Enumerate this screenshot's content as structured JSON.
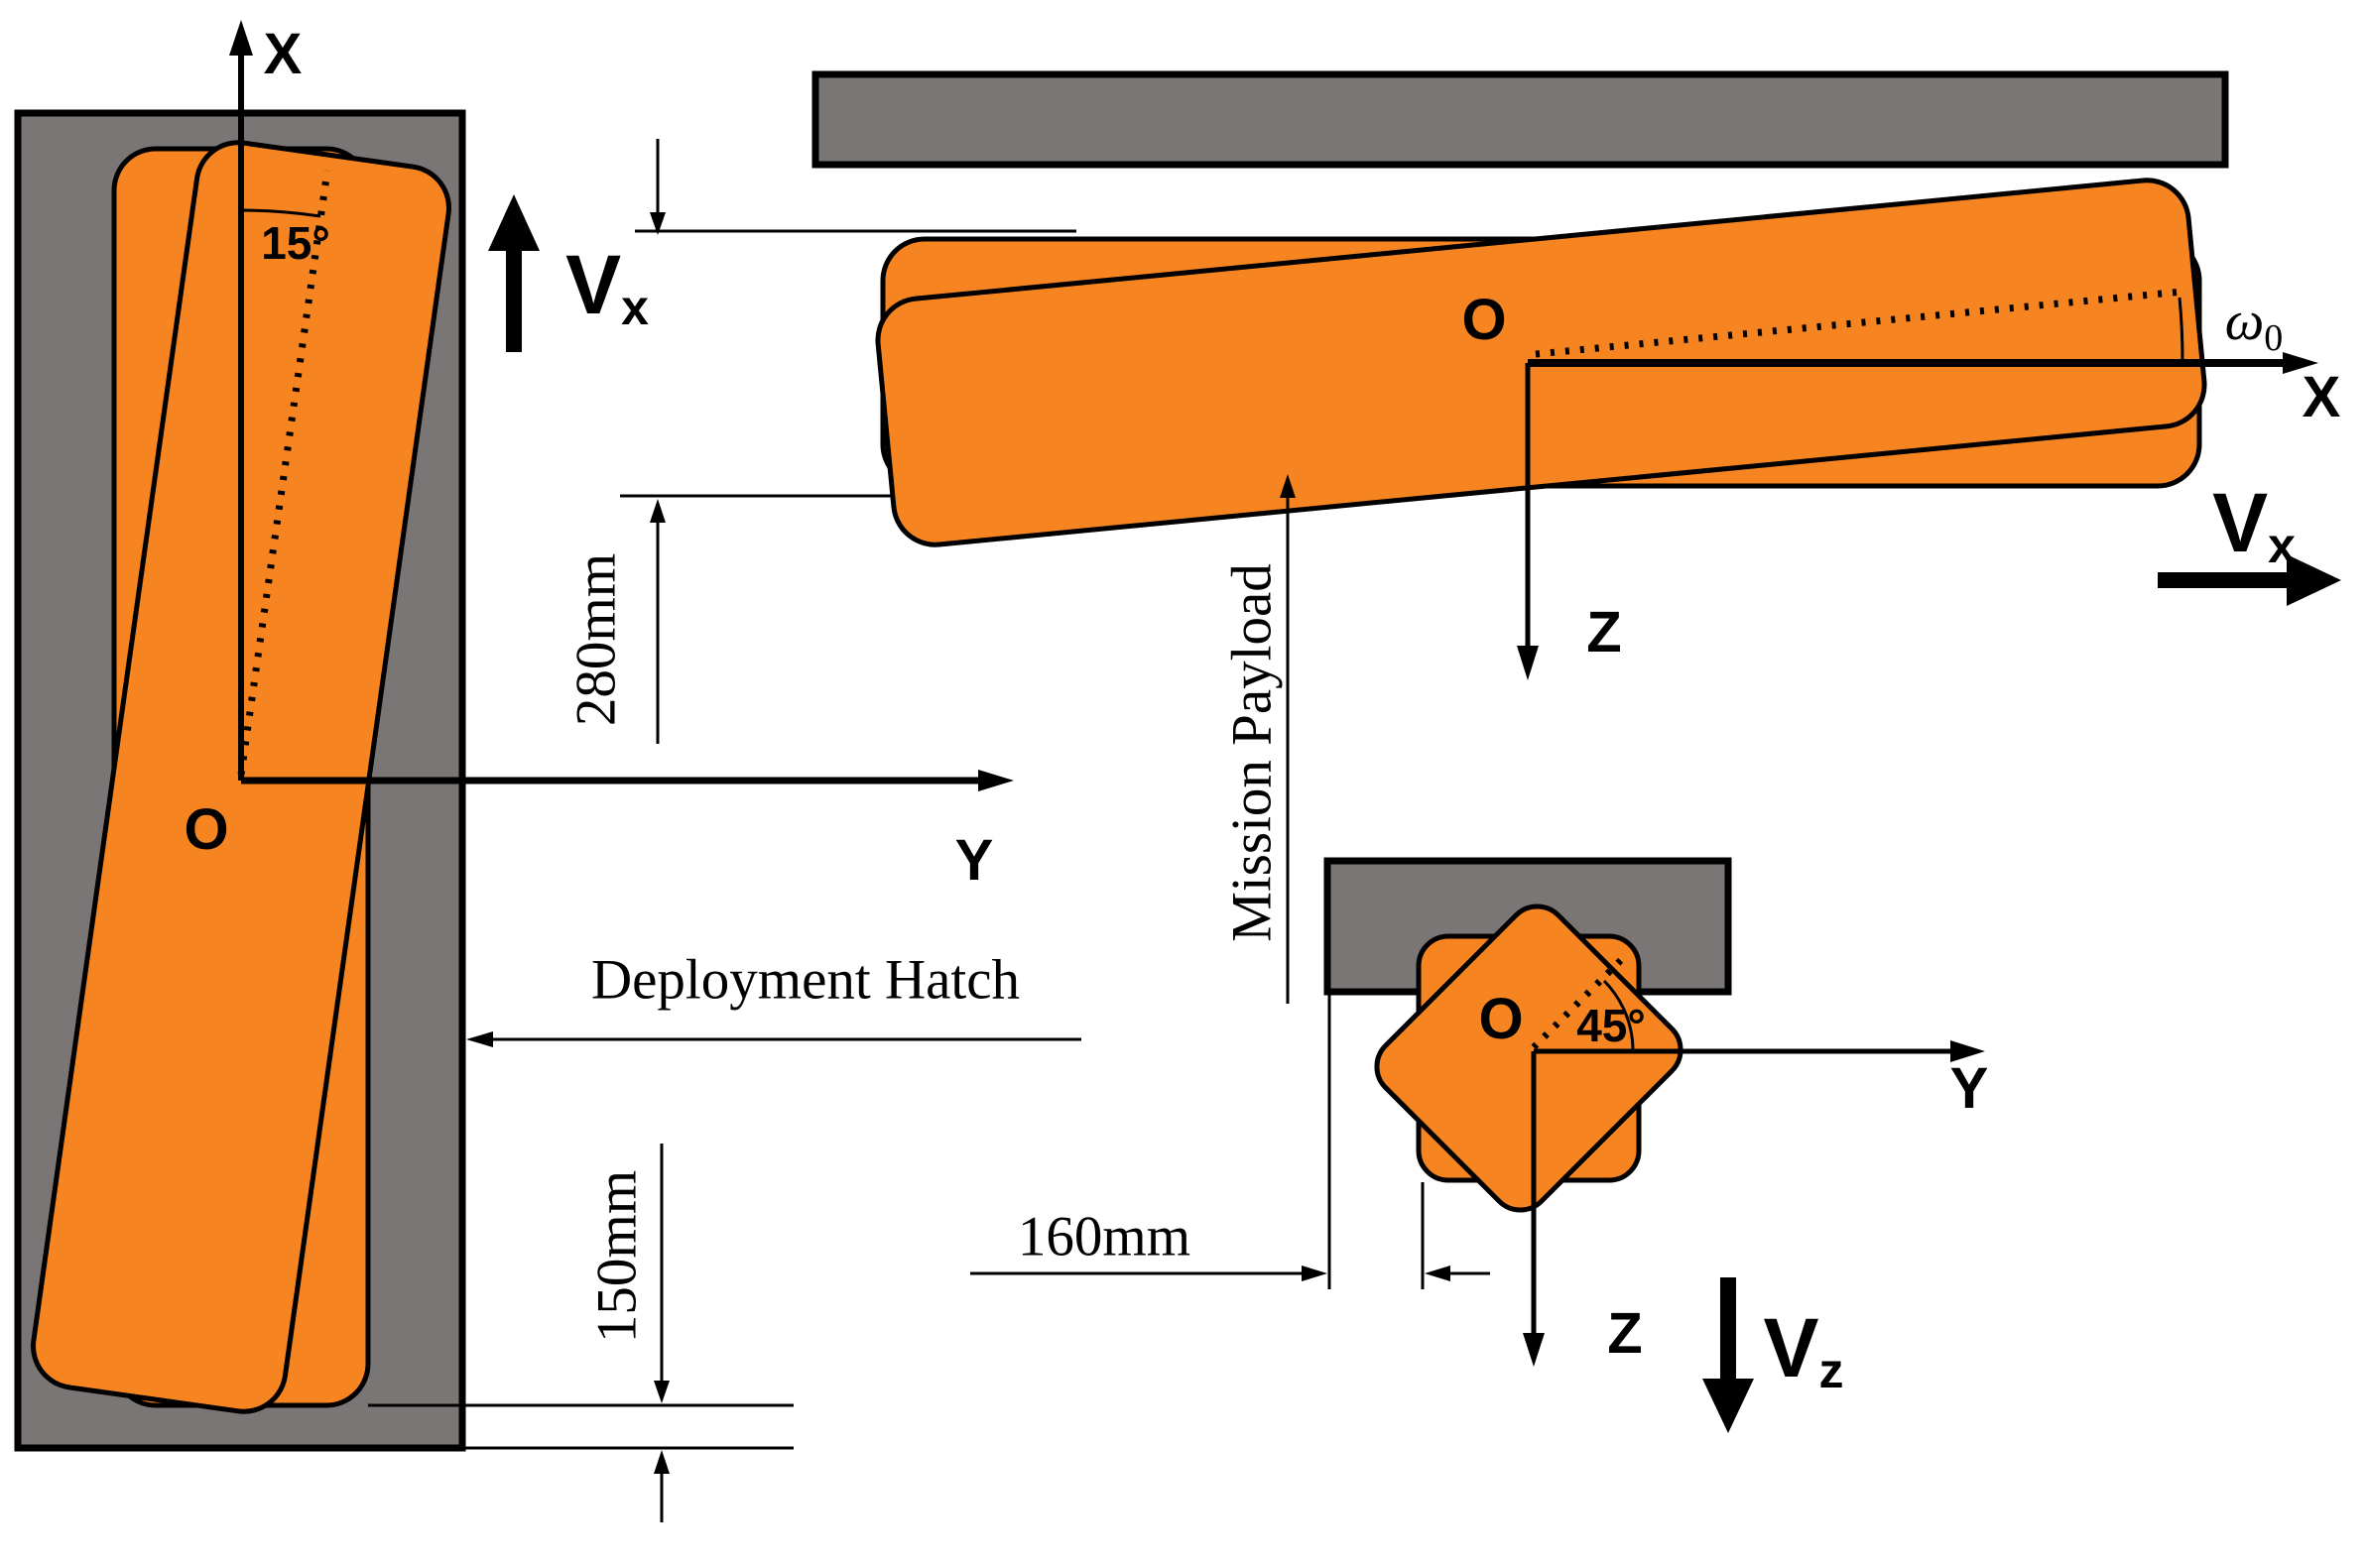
{
  "colors": {
    "payload_orange": "#F68420",
    "hatch_gray": "#7B7676",
    "line_black": "#000000"
  },
  "side_view": {
    "axis_x_label": "X",
    "axis_y_label": "Y",
    "origin_label": "O",
    "tilt_angle_label": "15°",
    "velocity_label": {
      "base": "V",
      "sub": "x"
    },
    "offset_dim_label": "280mm",
    "depth_dim_label": "150mm",
    "hatch_label": "Deployment Hatch"
  },
  "top_view": {
    "axis_x_label": "X",
    "axis_z_label": "Z",
    "origin_label": "O",
    "spin_label": {
      "base": "ω",
      "sub": "0"
    },
    "velocity_label": {
      "base": "V",
      "sub": "x"
    },
    "payload_label": "Mission Payload"
  },
  "rear_view": {
    "axis_y_label": "Y",
    "axis_z_label": "Z",
    "origin_label": "O",
    "tilt_angle_label": "45°",
    "velocity_label": {
      "base": "V",
      "sub": "z"
    },
    "offset_dim_label": "160mm"
  }
}
